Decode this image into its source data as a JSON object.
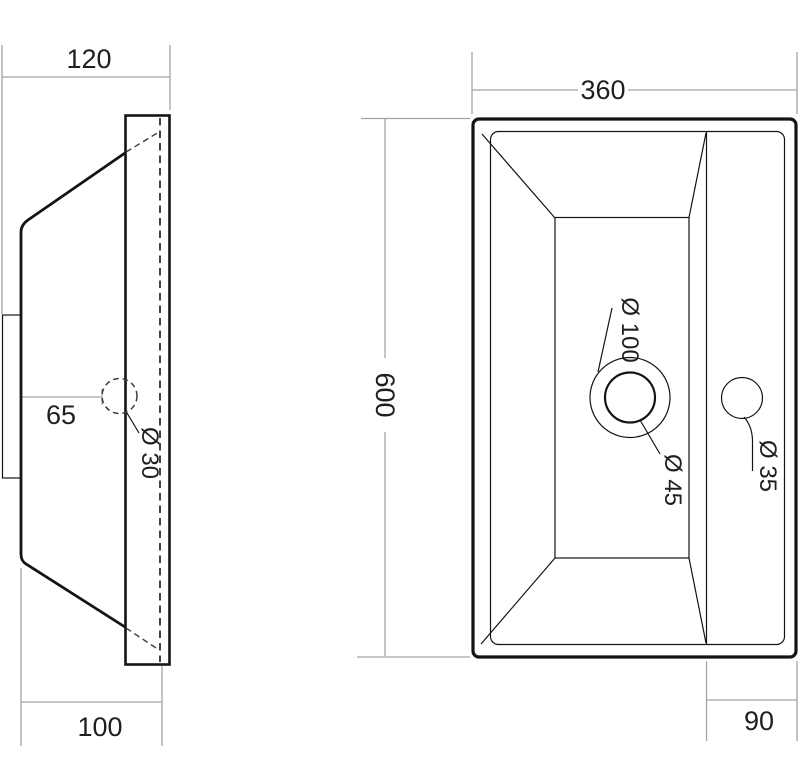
{
  "drawing": {
    "kind": "sink-technical-drawing",
    "colors": {
      "background": "#ffffff",
      "object_line": "#141414",
      "hidden_line": "#3a3a3a",
      "dimension_line": "#a3a3a3",
      "text": "#1f1f1f"
    },
    "side_view": {
      "dim_width_top": "120",
      "dim_hole_offset": "65",
      "dim_hole_diameter": "Ø 30",
      "dim_width_bottom": "100"
    },
    "top_view": {
      "dim_width": "360",
      "dim_length": "600",
      "dim_drain_recess_diameter": "Ø 100",
      "dim_drain_diameter": "Ø 45",
      "dim_faucet_hole_diameter": "Ø 35",
      "dim_deck_width": "90"
    }
  }
}
